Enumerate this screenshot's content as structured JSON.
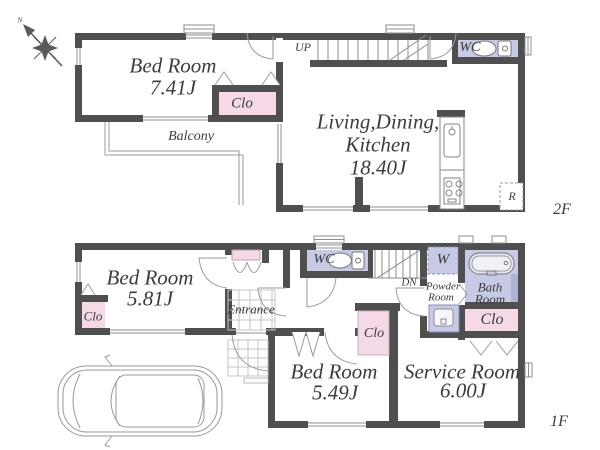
{
  "compass": {
    "north": "N"
  },
  "floor2": {
    "label": "2F",
    "bedroom": {
      "name": "Bed Room",
      "area": "7.41J"
    },
    "closet": "Clo",
    "balcony": "Balcony",
    "stairs": "UP",
    "ldk": {
      "line1": "Living,Dining,",
      "line2": "Kitchen",
      "area": "18.40J"
    },
    "wc": "WC",
    "refrigerator": "R"
  },
  "floor1": {
    "label": "1F",
    "bedroom_a": {
      "name": "Bed Room",
      "area": "5.81J"
    },
    "bedroom_a_closet": "Clo",
    "entrance": "Entrance",
    "wc": "WC",
    "stairs": "DN",
    "washer": "W",
    "powder_room": {
      "line1": "Powder",
      "line2": "Room"
    },
    "bath_room": {
      "line1": "Bath",
      "line2": "Room"
    },
    "bath_closet": "Clo",
    "bedroom_b": {
      "name": "Bed Room",
      "area": "5.49J"
    },
    "bedroom_b_closet": "Clo",
    "service_room": {
      "name": "Service Room",
      "area": "6.00J"
    }
  },
  "colors": {
    "wall": "#4f4f4f",
    "closet_fill": "#f5d9e7",
    "wet_area_fill": "#c6cae4",
    "thin_line": "#8c8c8c"
  }
}
